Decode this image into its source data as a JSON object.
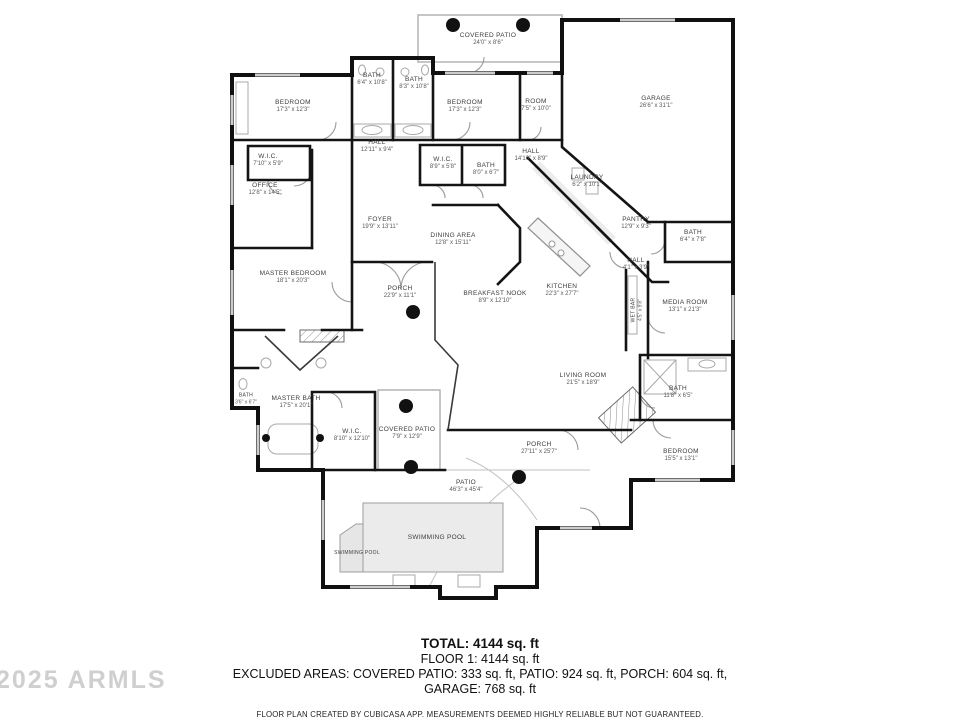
{
  "watermark": "2025 ARMLS",
  "footer": {
    "total": "TOTAL: 4144 sq. ft",
    "floor1": "FLOOR 1: 4144 sq. ft",
    "excluded_line1": "EXCLUDED AREAS: COVERED PATIO: 333 sq. ft, PATIO: 924 sq. ft, PORCH: 604 sq. ft,",
    "excluded_line2": "GARAGE: 768 sq. ft",
    "disclaimer": "FLOOR PLAN CREATED BY CUBICASA APP. MEASUREMENTS DEEMED HIGHLY RELIABLE BUT NOT GUARANTEED."
  },
  "rooms": [
    {
      "name": "COVERED PATIO",
      "dims": "24'0\" x 8'6\"",
      "x": 488,
      "y": 40
    },
    {
      "name": "BATH",
      "dims": "6'4\" x 10'8\"",
      "x": 372,
      "y": 80
    },
    {
      "name": "BATH",
      "dims": "8'3\" x 10'8\"",
      "x": 414,
      "y": 84
    },
    {
      "name": "BEDROOM",
      "dims": "17'3\" x 12'3\"",
      "x": 293,
      "y": 107
    },
    {
      "name": "BEDROOM",
      "dims": "17'3\" x 12'3\"",
      "x": 465,
      "y": 107
    },
    {
      "name": "ROOM",
      "dims": "7'5\" x 10'0\"",
      "x": 536,
      "y": 106
    },
    {
      "name": "GARAGE",
      "dims": "26'6\" x 31'1\"",
      "x": 656,
      "y": 103
    },
    {
      "name": "HALL",
      "dims": "12'11\" x 9'4\"",
      "x": 377,
      "y": 147
    },
    {
      "name": "W.I.C.",
      "dims": "7'10\" x 5'9\"",
      "x": 268,
      "y": 161
    },
    {
      "name": "W.I.C.",
      "dims": "8'9\" x 5'8\"",
      "x": 443,
      "y": 164
    },
    {
      "name": "BATH",
      "dims": "8'0\" x 6'7\"",
      "x": 486,
      "y": 170
    },
    {
      "name": "HALL",
      "dims": "14'10\" x 8'9\"",
      "x": 531,
      "y": 156
    },
    {
      "name": "LAUNDRY",
      "dims": "6'2\" x 10'1\"",
      "x": 587,
      "y": 182
    },
    {
      "name": "OFFICE",
      "dims": "12'8\" x 14'5\"",
      "x": 265,
      "y": 190
    },
    {
      "name": "FOYER",
      "dims": "19'9\" x 13'11\"",
      "x": 380,
      "y": 224
    },
    {
      "name": "DINING AREA",
      "dims": "12'8\" x 15'11\"",
      "x": 453,
      "y": 240
    },
    {
      "name": "PANTRY",
      "dims": "12'9\" x 9'3\"",
      "x": 636,
      "y": 224
    },
    {
      "name": "BATH",
      "dims": "6'4\" x 7'8\"",
      "x": 693,
      "y": 237
    },
    {
      "name": "HALL",
      "dims": "4'1\" x 3'9\"",
      "x": 636,
      "y": 265
    },
    {
      "name": "MASTER BEDROOM",
      "dims": "18'1\" x 20'3\"",
      "x": 293,
      "y": 278
    },
    {
      "name": "PORCH",
      "dims": "22'9\" x 11'1\"",
      "x": 400,
      "y": 293
    },
    {
      "name": "BREAKFAST NOOK",
      "dims": "8'9\" x 12'10\"",
      "x": 495,
      "y": 298
    },
    {
      "name": "KITCHEN",
      "dims": "22'3\" x 27'7\"",
      "x": 562,
      "y": 291
    },
    {
      "name": "WET BAR",
      "dims": "4'5\" x 9'8\"",
      "x": 637,
      "y": 310,
      "vertical": true,
      "small": true
    },
    {
      "name": "MEDIA ROOM",
      "dims": "13'1\" x 21'3\"",
      "x": 685,
      "y": 307
    },
    {
      "name": "LIVING ROOM",
      "dims": "21'5\" x 18'9\"",
      "x": 583,
      "y": 380
    },
    {
      "name": "BATH",
      "dims": "11'8\" x 6'5\"",
      "x": 678,
      "y": 393
    },
    {
      "name": "BATH",
      "dims": "3'6\" x 6'7\"",
      "x": 246,
      "y": 399,
      "small": true
    },
    {
      "name": "MASTER BATH",
      "dims": "17'5\" x 20'1\"",
      "x": 296,
      "y": 403
    },
    {
      "name": "W.I.C.",
      "dims": "8'10\" x 12'10\"",
      "x": 352,
      "y": 436
    },
    {
      "name": "COVERED PATIO",
      "dims": "7'9\" x 12'9\"",
      "x": 407,
      "y": 434
    },
    {
      "name": "PORCH",
      "dims": "27'11\" x 25'7\"",
      "x": 539,
      "y": 449
    },
    {
      "name": "BEDROOM",
      "dims": "15'5\" x 13'1\"",
      "x": 681,
      "y": 456
    },
    {
      "name": "PATIO",
      "dims": "46'3\" x 45'4\"",
      "x": 466,
      "y": 487
    },
    {
      "name": "SWIMMING POOL",
      "dims": "",
      "x": 437,
      "y": 538
    },
    {
      "name": "SWIMMING POOL",
      "dims": "",
      "x": 357,
      "y": 553,
      "small": true
    }
  ]
}
